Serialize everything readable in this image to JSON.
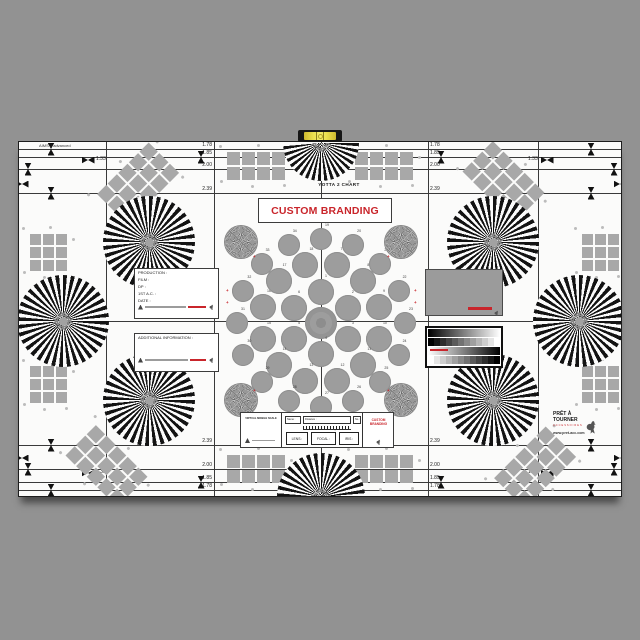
{
  "chart": {
    "standard_label": "AIMS 2 advanced",
    "title": "YOTTA 2 CHART",
    "branding_banner": "CUSTOM BRANDING",
    "aspect_ratios": {
      "r178": "1.78",
      "r185": "1.85",
      "r200": "2.00",
      "r239": "2.39",
      "r133": "1.33"
    }
  },
  "production_box": {
    "fields": [
      "PRODUCTION :",
      "FILM :",
      "DP :",
      "1ST A.C. :",
      "DATE :"
    ]
  },
  "info_box": {
    "header": "ADDITIONAL INFORMATION :"
  },
  "slate": {
    "scale_label": "VIRTUAL MOBILE SCALE",
    "name_label": "Name :",
    "distance_label": "Distance :",
    "no_label": "No :",
    "scale_chars": "ABCDEFGHIJKLMNOPQRSTUVW",
    "lens_label": "LENS :",
    "focal_label": "FOCAL :",
    "iris_label": "IRIS :",
    "branding": "CUSTOM BRANDING"
  },
  "logo": {
    "name_line1": "PRÊT À",
    "name_line2": "TOURNER",
    "tagline": "ACCESSOIRES",
    "website": "www.pret-acc.com"
  },
  "circle_numbers": [
    "1",
    "2",
    "3",
    "4",
    "5",
    "6",
    "7",
    "8",
    "9",
    "10",
    "11",
    "12",
    "13",
    "14",
    "15",
    "16",
    "17",
    "18",
    "19",
    "20",
    "21",
    "22",
    "23",
    "24",
    "25",
    "26",
    "27",
    "28",
    "29",
    "30",
    "31",
    "32",
    "33",
    "34"
  ],
  "colors": {
    "accent_red": "#c9252b",
    "patch_gray": "#9b9b9b",
    "background": "#929292"
  }
}
